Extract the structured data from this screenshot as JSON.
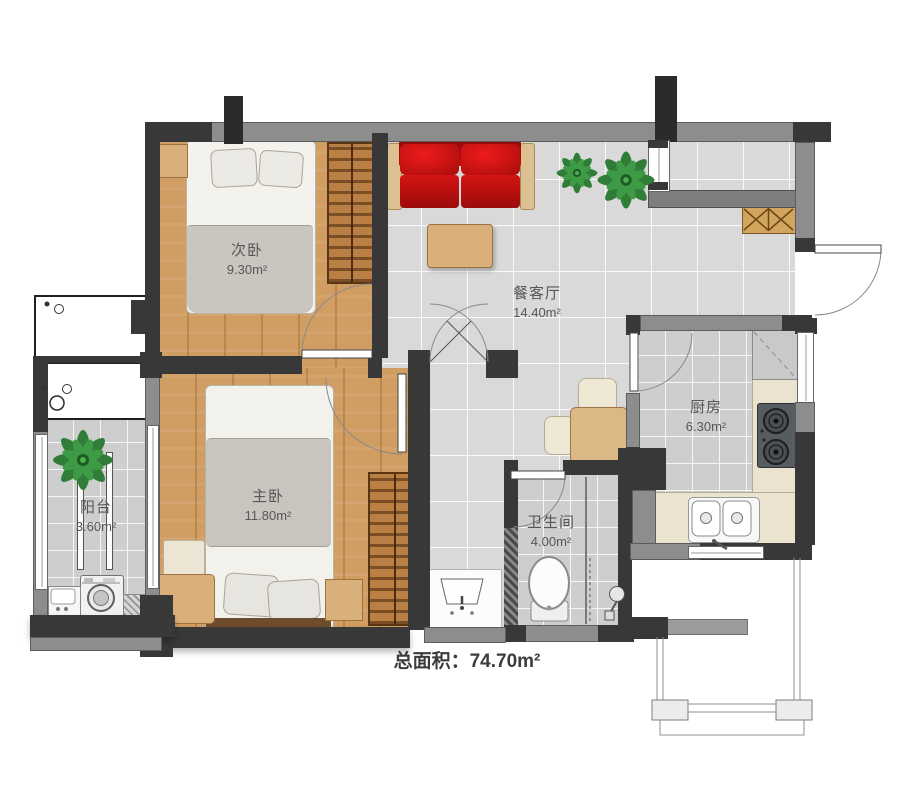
{
  "page": {
    "type": "apartment-floor-plan",
    "background": "#ffffff"
  },
  "total_area": {
    "label": "总面积：",
    "value": "74.70m²"
  },
  "rooms": [
    {
      "id": "secondary-bedroom",
      "name": "次卧",
      "area": "9.30m²"
    },
    {
      "id": "living-dining-room",
      "name": "餐客厅",
      "area": "14.40m²"
    },
    {
      "id": "master-bedroom",
      "name": "主卧",
      "area": "11.80m²"
    },
    {
      "id": "balcony",
      "name": "阳台",
      "area": "3.60m²"
    },
    {
      "id": "bathroom",
      "name": "卫生间",
      "area": "4.00m²"
    },
    {
      "id": "kitchen",
      "name": "厨房",
      "area": "6.30m²"
    }
  ],
  "colors": {
    "wall_dark": "#383838",
    "wall_gray": "#8d8d8d",
    "wood_floor": "#d09d62",
    "tile_large": "#d9d9d9",
    "tile_small": "#cecece",
    "sofa_red": "#c41212",
    "counter_cream": "#ebe3cf",
    "furniture_tan": "#d9b07a",
    "plant_green": "#2f7d36",
    "label_text": "#575757"
  }
}
